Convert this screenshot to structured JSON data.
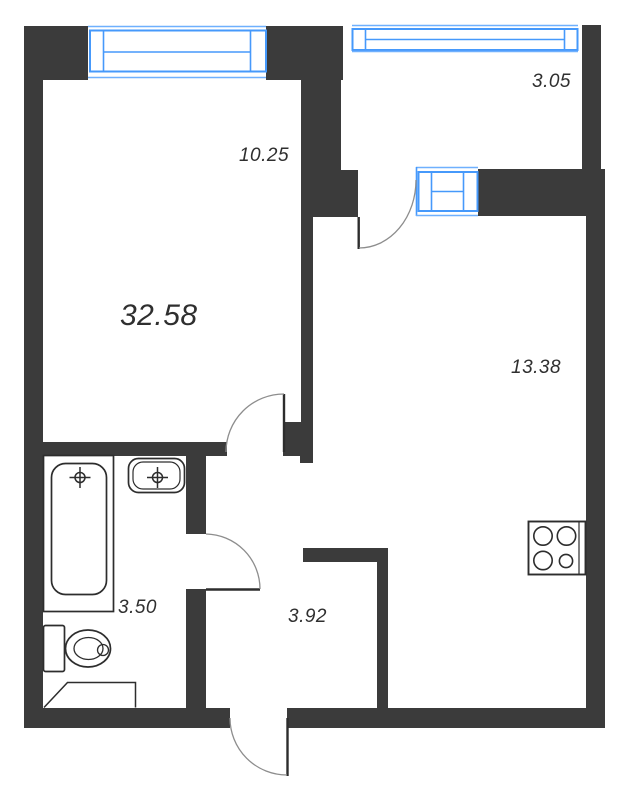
{
  "areas": {
    "total": "32.58",
    "room": "10.25",
    "balcony": "3.05",
    "kitchen": "13.38",
    "bathroom": "3.50",
    "hallway": "3.92"
  },
  "colors": {
    "wall": "#3b3b3b",
    "window_frame": "#4699fb",
    "window_thin_line": "#6fb0fe",
    "fixture_line": "#2d2d2d",
    "door_leaf": "#2d2d2d",
    "door_arc": "#8d8d8d",
    "label_text": "#2f2f2f",
    "background": "#ffffff"
  },
  "fixtures": [
    "bathtub",
    "sink",
    "toilet",
    "stove",
    "washing-machine-slot"
  ],
  "openings": [
    "room-door",
    "bathroom-door",
    "balcony-door",
    "entrance-door"
  ],
  "windows": [
    "room-window",
    "balcony-window",
    "balcony-door-window"
  ]
}
